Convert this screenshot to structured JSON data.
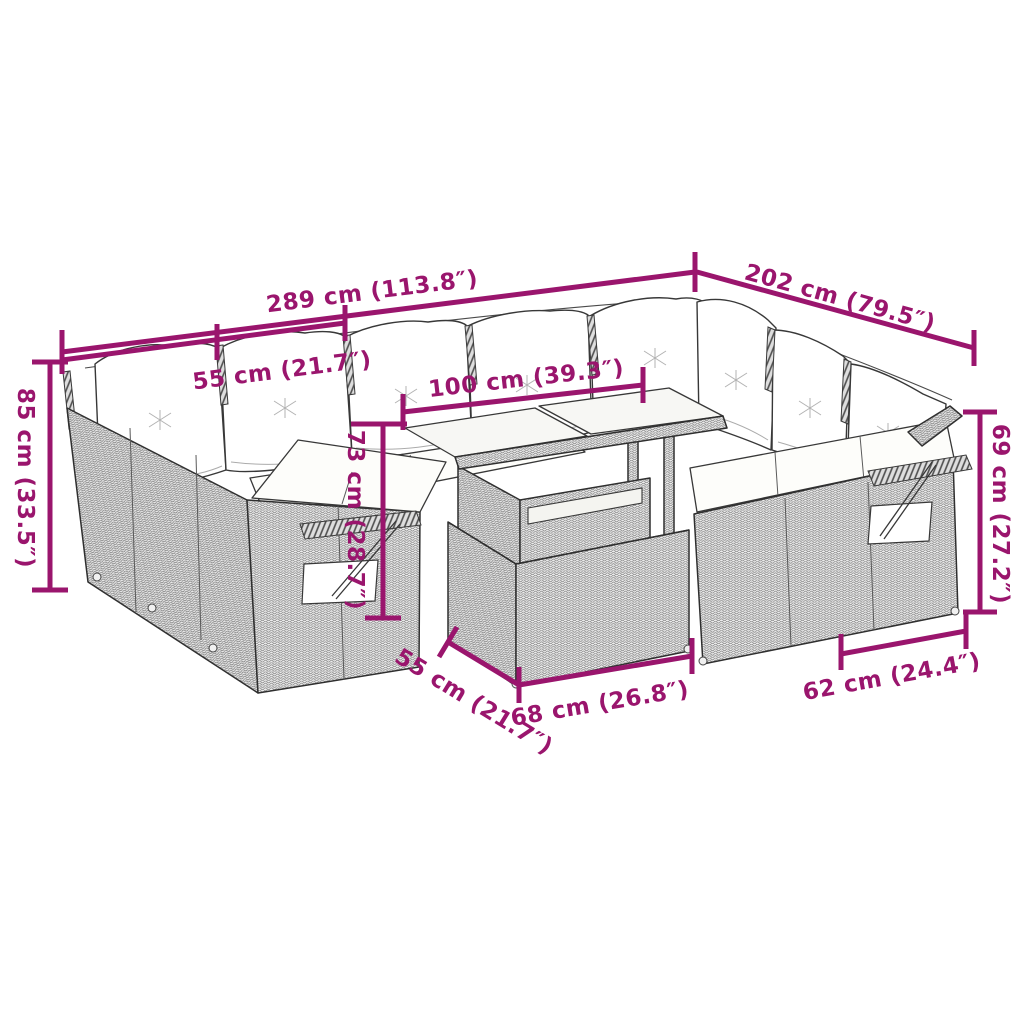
{
  "illustration": {
    "subject": "rattan-garden-lounge-set-dimension-diagram",
    "background_color": "#ffffff",
    "accent_color": "#9a156d",
    "outline_color": "#2f2f2f"
  },
  "dims": {
    "total_width": "289 cm (113.8″)",
    "right_depth": "202 cm (79.5″)",
    "seat_width": "55 cm (21.7″)",
    "table_length": "100 cm (39.3″)",
    "back_height": "85 cm (33.5″)",
    "table_height": "73 cm (28.7″)",
    "right_back_height": "69 cm (27.2″)",
    "table_depth": "55 cm (21.7″)",
    "table_front_width": "68 cm (26.8″)",
    "right_seat_depth": "62 cm (24.4″)"
  }
}
